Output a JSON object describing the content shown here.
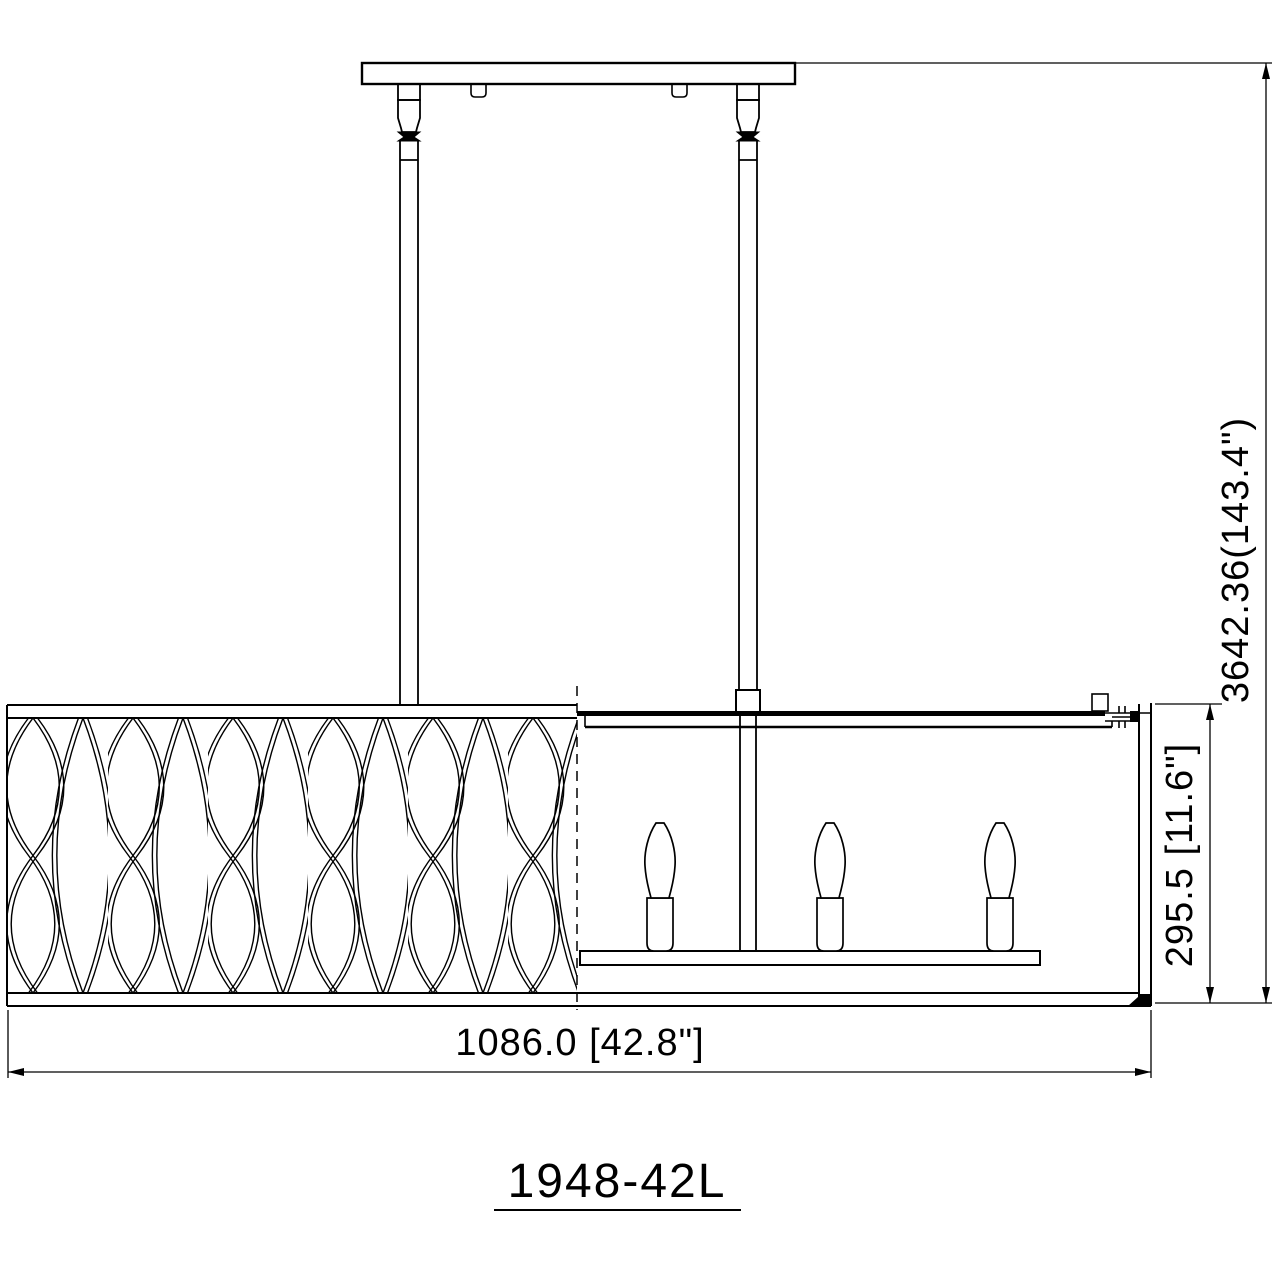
{
  "drawing": {
    "model_number": "1948-42L",
    "dimensions": {
      "overall_width": "1086.0 [42.8\"]",
      "shade_height": "295.5 [11.6\"]",
      "overall_height": "3642.36(143.4\")"
    },
    "fixture": {
      "type": "linear chandelier dimension drawing",
      "visible_lamp_count": 3,
      "downrod_count": 2
    },
    "colors": {
      "line": "#000000",
      "background": "#ffffff"
    }
  }
}
